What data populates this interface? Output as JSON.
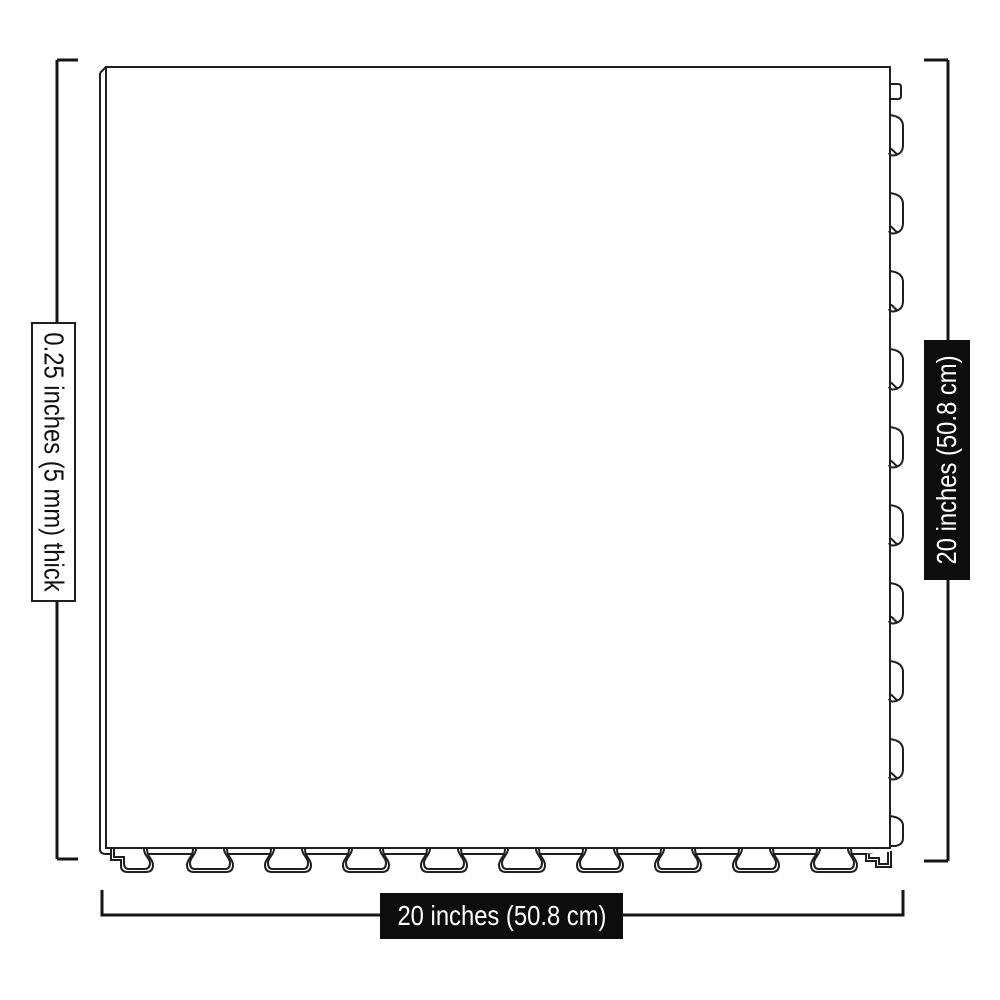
{
  "diagram": {
    "labels": {
      "thickness": "0.25 inches (5 mm) thick",
      "height": "20 inches (50.8 cm)",
      "width": "20 inches (50.8 cm)"
    },
    "colors": {
      "background": "#ffffff",
      "line": "#1f1f1f",
      "dimension_line": "#151515",
      "dark_label_bg": "#0d0d0d",
      "dark_label_text": "#ffffff",
      "light_label_bg": "#ffffff",
      "light_label_text": "#111111"
    }
  }
}
